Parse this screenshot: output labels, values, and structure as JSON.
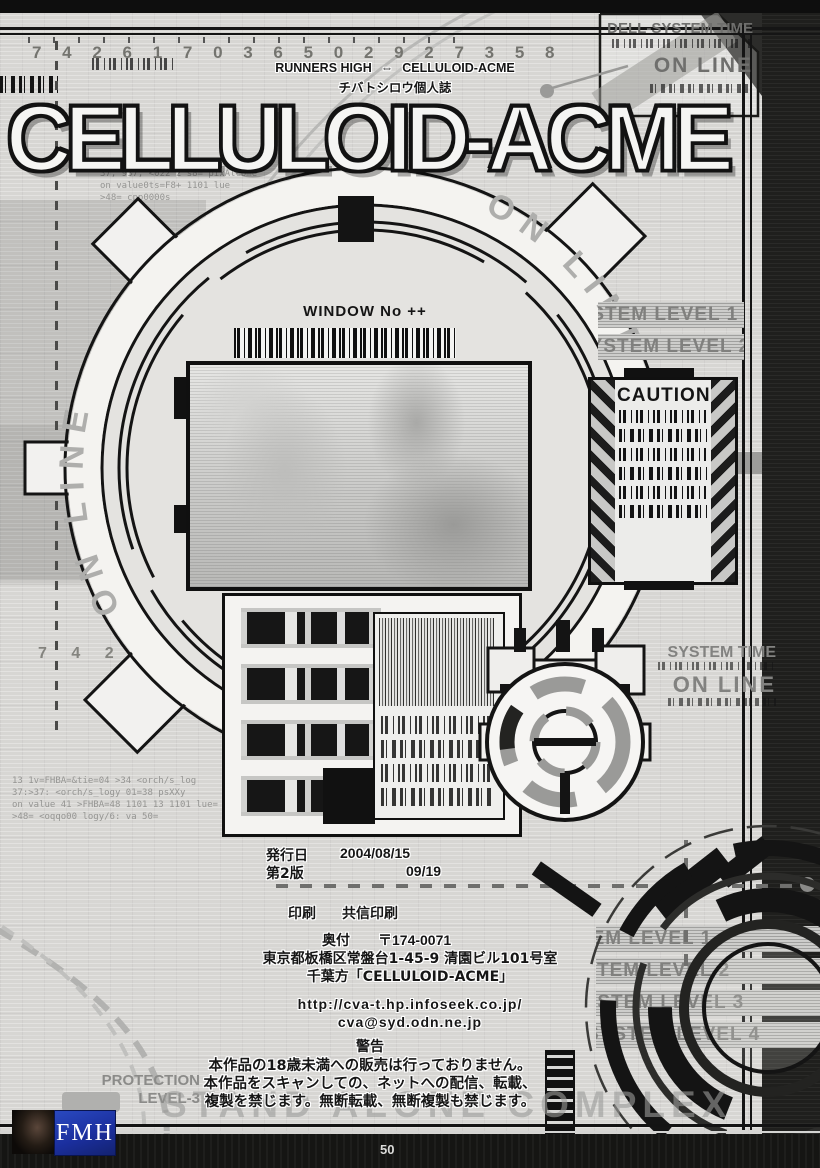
{
  "colors": {
    "paper": "#d7d6d3",
    "ink": "#141414",
    "gray_text": "#80807e",
    "logo_blue": "#2a49c0"
  },
  "header": {
    "serial_digits": "7 4 2 6 1 7 0 3 6 5 0 2 9 2 7 3 5 8",
    "runners_left": "RUNNERS HIGH",
    "runners_arrow": "⇔",
    "runners_right": "CELLULOID-ACME",
    "doujin_note": "チバトシロウ個人誌",
    "title": "CELLULOID-ACME"
  },
  "top_right": {
    "line1": "DELL-SYSTEM TIME",
    "line2": "ON LINE"
  },
  "dial": {
    "online_left": "ON LINE",
    "online_right": "ON LINE",
    "window_label": "WINDOW No ++"
  },
  "side_right": {
    "level_band_1": "SYSTEM LEVEL 1",
    "level_band_2": "SYSTEM LEVEL 2",
    "caution": "CAUTION",
    "system_time": "SYSTEM TIME",
    "online": "ON LINE"
  },
  "side_left": {
    "digits": "7 4 2",
    "code_top_1": "37; 937; <022 2   s8= pixAlcome",
    "code_top_2": "on value0ts=F8+   1101 lue",
    "code_top_3": ">48= cpp0000s",
    "code_bottom_1": "13 1v=FHBA=&tie=04 >34 <orch/s_log",
    "code_bottom_2": "37:>37: <orch/s_logy 01=38 psXXy",
    "code_bottom_3": "on value 41 >FHBA=48 1101 13 1101 lue=",
    "code_bottom_4": ">48= <oqqo00 logy/6: va 50="
  },
  "colophon": {
    "issue_label": "発行日",
    "issue_date": "2004/08/15",
    "edition_label": "第2版",
    "edition_date": "09/19",
    "print_label": "印刷",
    "printer": "共信印刷",
    "okuzuke_label": "奥付",
    "postal_code": "〒174-0071",
    "address": "東京都板橋区常盤台1-45-9 清園ビル101号室",
    "care_of": "千葉方「CELLULOID-ACME」",
    "url": "http://cva-t.hp.infoseek.co.jp/",
    "email": "cva@syd.odn.ne.jp"
  },
  "warning": {
    "title": "警告",
    "line1": "本作品の18歳未満への販売は行っておりません。",
    "line2": "本作品をスキャンしての、ネットへの配信、転載、",
    "line3": "複製を禁じます。無断転載、無断複製も禁じます。"
  },
  "footer": {
    "protection_line1": "PROTECTION",
    "protection_line2": "LEVEL-3",
    "stand_alone": "STAND ALONE COMPLEX",
    "logo_text": "FMH",
    "page_number": "50",
    "level_band_1": "SYSTEM LEVEL 1",
    "level_band_2": "SYSTEM LEVEL 2",
    "level_band_3": "SYSTEM LEVEL 3",
    "level_band_4": "SYSTEM LEVEL 4"
  }
}
